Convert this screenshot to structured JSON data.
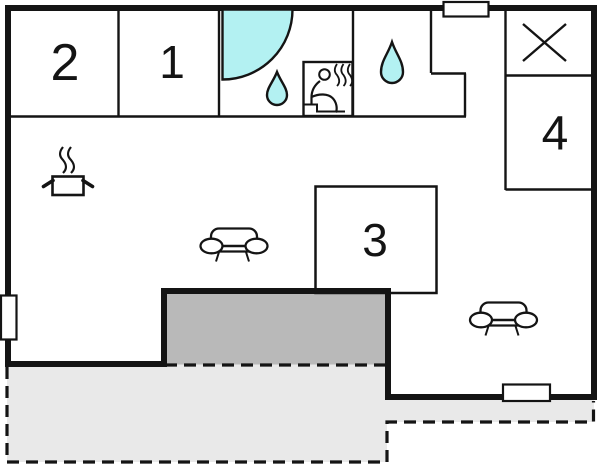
{
  "plan": {
    "type": "floor-plan",
    "rooms": [
      {
        "id": "room-2",
        "label": "2"
      },
      {
        "id": "room-1",
        "label": "1"
      },
      {
        "id": "room-3",
        "label": "3"
      },
      {
        "id": "room-4",
        "label": "4"
      }
    ],
    "icons": [
      "shower-icon",
      "water-drop-icon",
      "water-drop-icon",
      "sauna-icon",
      "cooking-pot-icon",
      "steam-icon",
      "sofa-icon",
      "sofa-icon",
      "cross-icon",
      "window-icon"
    ],
    "colors": {
      "wall": "#141414",
      "water": "#b3f1f2",
      "veranda": "#b9b9b9",
      "terrace": "#e9e9e9",
      "background": "#ffffff"
    }
  }
}
